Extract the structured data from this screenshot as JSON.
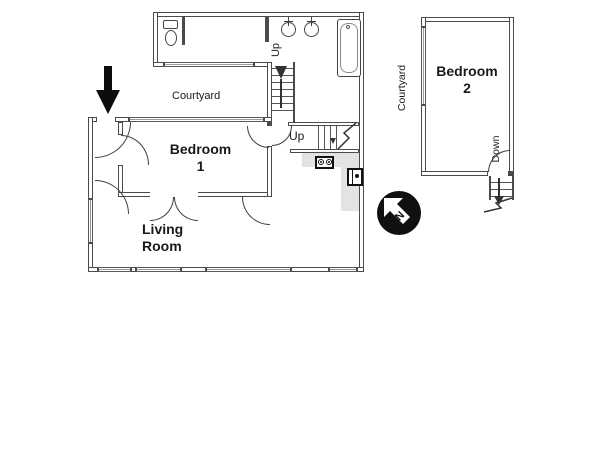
{
  "colors": {
    "wall": "#4b4b4b",
    "counter": "#e3e3e3",
    "ink": "#1a1a1a",
    "compass_bg": "#101010"
  },
  "floor1": {
    "courtyard_label": "Courtyard",
    "bedroom1_line1": "Bedroom",
    "bedroom1_line2": "1",
    "living_line1": "Living",
    "living_line2": "Room",
    "stairs_up_label": "Up",
    "passage_up_label": "Up"
  },
  "floor2": {
    "courtyard_label": "Courtyard",
    "bedroom2_line1": "Bedroom",
    "bedroom2_line2": "2",
    "down_label": "Down"
  },
  "compass": {
    "north_label": "N"
  }
}
